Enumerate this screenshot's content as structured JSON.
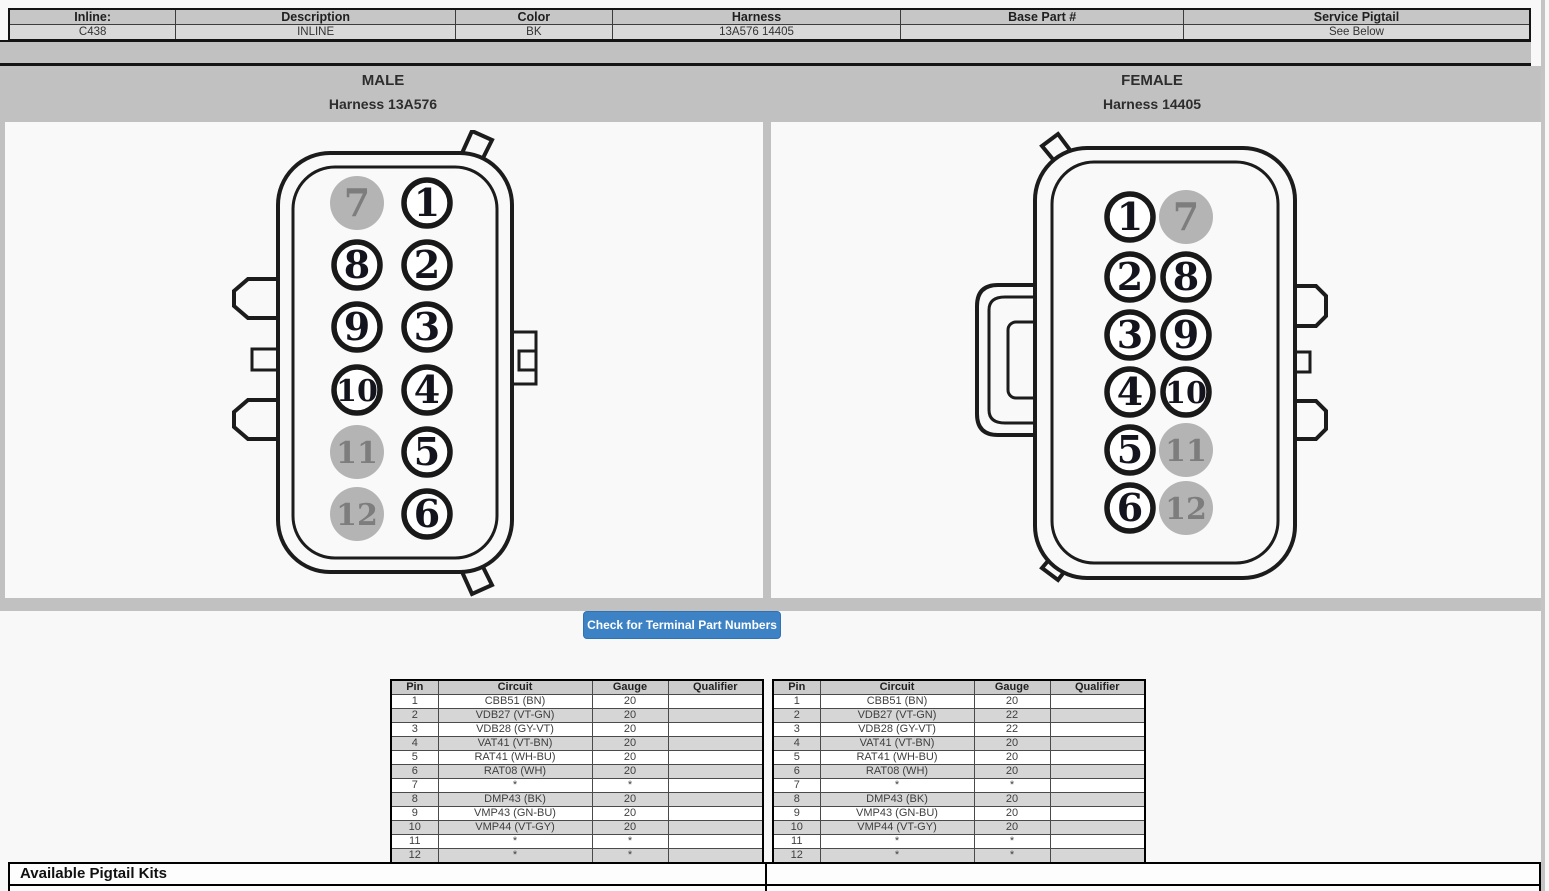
{
  "header_table": {
    "columns": [
      {
        "label": "Inline:",
        "value": "C438"
      },
      {
        "label": "Description",
        "value": "INLINE"
      },
      {
        "label": "Color",
        "value": "BK"
      },
      {
        "label": "Harness",
        "value": "13A576 14405"
      },
      {
        "label": "Base Part #",
        "value": ""
      },
      {
        "label": "Service Pigtail",
        "value": "See Below"
      }
    ]
  },
  "connectors": {
    "male": {
      "title": "MALE",
      "subtitle": "Harness 13A576",
      "left_column_pins": [
        "7",
        "8",
        "9",
        "10",
        "11",
        "12"
      ],
      "right_column_pins": [
        "1",
        "2",
        "3",
        "4",
        "5",
        "6"
      ],
      "gray_pins": [
        "7",
        "11",
        "12"
      ]
    },
    "female": {
      "title": "FEMALE",
      "subtitle": "Harness 14405",
      "left_column_pins": [
        "1",
        "2",
        "3",
        "4",
        "5",
        "6"
      ],
      "right_column_pins": [
        "7",
        "8",
        "9",
        "10",
        "11",
        "12"
      ],
      "gray_pins": [
        "7",
        "11",
        "12"
      ]
    }
  },
  "terminal_button": {
    "label": "Check for Terminal Part Numbers"
  },
  "pin_tables": {
    "headers": [
      "Pin",
      "Circuit",
      "Gauge",
      "Qualifier"
    ],
    "male": {
      "rows": [
        [
          "1",
          "CBB51 (BN)",
          "20",
          ""
        ],
        [
          "2",
          "VDB27 (VT-GN)",
          "20",
          ""
        ],
        [
          "3",
          "VDB28 (GY-VT)",
          "20",
          ""
        ],
        [
          "4",
          "VAT41 (VT-BN)",
          "20",
          ""
        ],
        [
          "5",
          "RAT41 (WH-BU)",
          "20",
          ""
        ],
        [
          "6",
          "RAT08 (WH)",
          "20",
          ""
        ],
        [
          "7",
          "*",
          "*",
          ""
        ],
        [
          "8",
          "DMP43 (BK)",
          "20",
          ""
        ],
        [
          "9",
          "VMP43 (GN-BU)",
          "20",
          ""
        ],
        [
          "10",
          "VMP44 (VT-GY)",
          "20",
          ""
        ],
        [
          "11",
          "*",
          "*",
          ""
        ],
        [
          "12",
          "*",
          "*",
          ""
        ]
      ]
    },
    "female": {
      "rows": [
        [
          "1",
          "CBB51 (BN)",
          "20",
          ""
        ],
        [
          "2",
          "VDB27 (VT-GN)",
          "22",
          ""
        ],
        [
          "3",
          "VDB28 (GY-VT)",
          "22",
          ""
        ],
        [
          "4",
          "VAT41 (VT-BN)",
          "20",
          ""
        ],
        [
          "5",
          "RAT41 (WH-BU)",
          "20",
          ""
        ],
        [
          "6",
          "RAT08 (WH)",
          "20",
          ""
        ],
        [
          "7",
          "*",
          "*",
          ""
        ],
        [
          "8",
          "DMP43 (BK)",
          "20",
          ""
        ],
        [
          "9",
          "VMP43 (GN-BU)",
          "20",
          ""
        ],
        [
          "10",
          "VMP44 (VT-GY)",
          "20",
          ""
        ],
        [
          "11",
          "*",
          "*",
          ""
        ],
        [
          "12",
          "*",
          "*",
          ""
        ]
      ]
    }
  },
  "pigtail_section": {
    "title": "Available Pigtail Kits",
    "part_number_label": "Pigtail Kit Part Number",
    "part_number_value": "WPT-1485"
  },
  "colors": {
    "band_gray": "#c1c1c1",
    "header_label_bg": "#c6c6c6",
    "header_value_bg": "#d9d9d9",
    "table_header_bg": "#cccccc",
    "table_alt_row_bg": "#d6d6d6",
    "button_blue": "#3d82c4",
    "pin_gray_fill": "#b4b4b4",
    "pin_gray_text": "#7d7d7d",
    "outline_black": "#1c1c1c",
    "panel_white": "#f9f9f9"
  }
}
